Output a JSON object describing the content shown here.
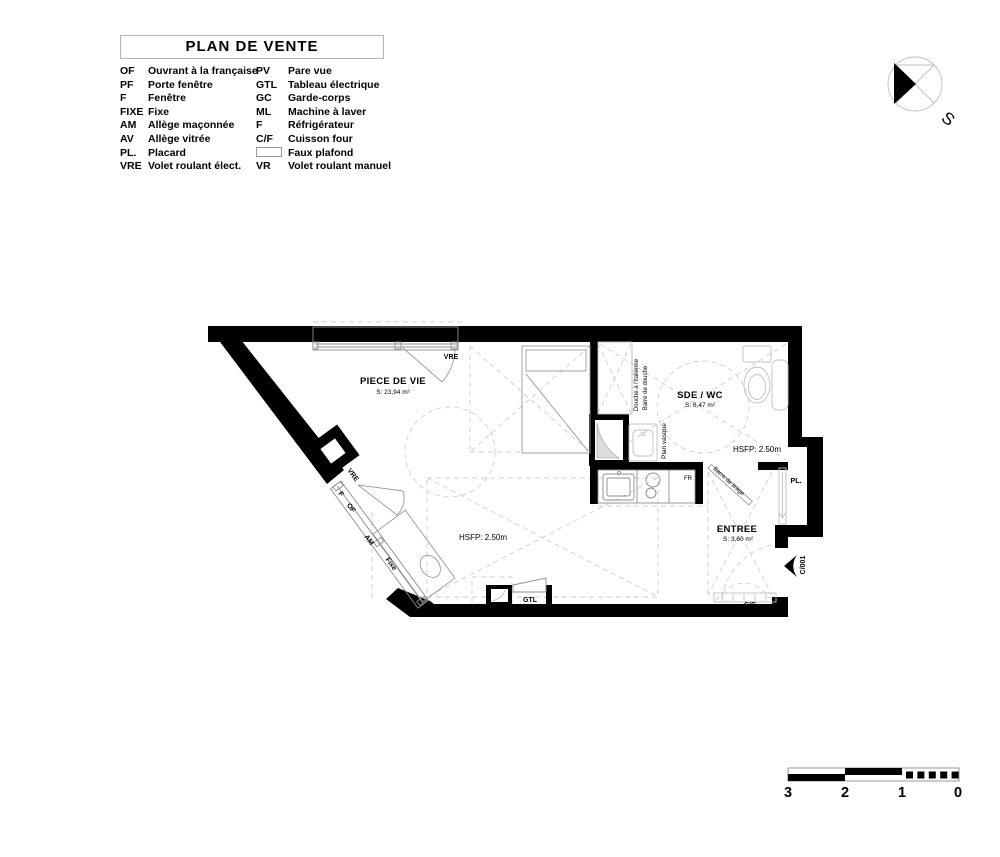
{
  "legend": {
    "title": "PLAN DE VENTE",
    "rows": [
      {
        "a1": "OF",
        "l1": "Ouvrant à la française",
        "a2": "PV",
        "l2": "Pare vue"
      },
      {
        "a1": "PF",
        "l1": "Porte fenêtre",
        "a2": "GTL",
        "l2": "Tableau électrique"
      },
      {
        "a1": "F",
        "l1": "Fenêtre",
        "a2": "GC",
        "l2": "Garde-corps"
      },
      {
        "a1": "FIXE",
        "l1": "Fixe",
        "a2": "ML",
        "l2": "Machine à laver"
      },
      {
        "a1": "AM",
        "l1": "Allège maçonnée",
        "a2": "F",
        "l2": "Réfrigérateur"
      },
      {
        "a1": "AV",
        "l1": "Allège vitrée",
        "a2": "C/F",
        "l2": "Cuisson four"
      },
      {
        "a1": "PL.",
        "l1": "Placard",
        "a2": "",
        "l2": "Faux plafond"
      },
      {
        "a1": "VRE",
        "l1": "Volet roulant élect.",
        "a2": "VR",
        "l2": "Volet roulant manuel"
      }
    ]
  },
  "plan": {
    "rooms": {
      "piece_de_vie": {
        "name": "PIECE DE VIE",
        "area": "S: 23,94 m²"
      },
      "sde_wc": {
        "name": "SDE / WC",
        "area": "S: 6,47 m²"
      },
      "entree": {
        "name": "ENTREE",
        "area": "S: 3,60 m²"
      }
    },
    "hsfp_living": "HSFP: 2.50m",
    "hsfp_entree": "HSFP: 2.50m",
    "top_window": {
      "f": "F",
      "fixe": "Fixe",
      "am": "AM",
      "of": "OF",
      "vre": "VRE"
    },
    "diag_window": {
      "vre": "VRE",
      "f": "F",
      "of": "OF",
      "am": "AM",
      "fixe": "Fixe"
    },
    "annotations": {
      "douche": "Douche à l'italienne",
      "barre_douche": "Barre de douche",
      "plan_vasque": "Plan vasque",
      "barre_tirage": "Barre de tirage",
      "fr": "FR",
      "pl": "PL.",
      "gtl": "GTL",
      "cc": "C/C",
      "door_ref": "C/001"
    }
  },
  "compass": {
    "south": "S"
  },
  "scale_bar": {
    "labels": [
      "3",
      "2",
      "1",
      "0"
    ]
  }
}
